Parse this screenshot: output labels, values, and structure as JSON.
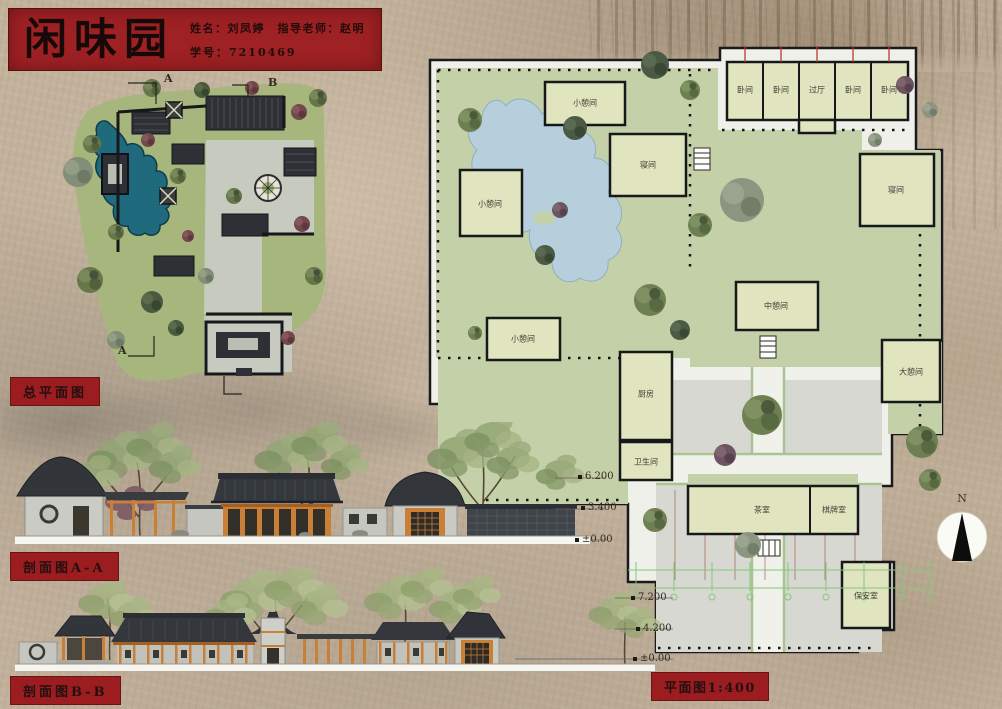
{
  "title_block": {
    "title": "闲味园",
    "name_line": "姓名：刘凤婷　指导老师：赵明",
    "id_line": "学号：7210469"
  },
  "labels": {
    "site_plan": "总平面图",
    "section_a": "剖面图A-A",
    "section_b": "剖面图B-B",
    "plan_scale": "平面图1:400"
  },
  "compass": {
    "north": "N"
  },
  "section_marks": {
    "top_a": "A",
    "top_b": "B",
    "bottom_a": "A"
  },
  "floor_plan": {
    "rooms": [
      {
        "label": "小憩间",
        "x": 163,
        "y": 81
      },
      {
        "label": "寝间",
        "x": 226,
        "y": 143
      },
      {
        "label": "卧间",
        "x": 323,
        "y": 68
      },
      {
        "label": "卧间",
        "x": 359,
        "y": 68
      },
      {
        "label": "过厅",
        "x": 395,
        "y": 68
      },
      {
        "label": "卧间",
        "x": 431,
        "y": 68
      },
      {
        "label": "卧间",
        "x": 467,
        "y": 68
      },
      {
        "label": "寝间",
        "x": 474,
        "y": 168
      },
      {
        "label": "小憩间",
        "x": 68,
        "y": 182
      },
      {
        "label": "中憩间",
        "x": 354,
        "y": 284
      },
      {
        "label": "小憩间",
        "x": 101,
        "y": 317
      },
      {
        "label": "大憩间",
        "x": 489,
        "y": 350
      },
      {
        "label": "厨房",
        "x": 224,
        "y": 372
      },
      {
        "label": "卫生间",
        "x": 224,
        "y": 440
      },
      {
        "label": "茶室",
        "x": 340,
        "y": 488
      },
      {
        "label": "棋牌室",
        "x": 412,
        "y": 488
      },
      {
        "label": "保安室",
        "x": 444,
        "y": 574
      }
    ]
  },
  "elevations": {
    "section_a_marks": [
      {
        "label": "6.200",
        "x": 563,
        "y": 49
      },
      {
        "label": "3.400",
        "x": 566,
        "y": 80
      },
      {
        "label": "±0.00",
        "x": 560,
        "y": 112
      }
    ],
    "section_b_marks": [
      {
        "label": "7.200",
        "x": 616,
        "y": 24
      },
      {
        "label": "4.200",
        "x": 621,
        "y": 55
      },
      {
        "label": "±0.00",
        "x": 618,
        "y": 85
      }
    ]
  },
  "colors": {
    "accent_red": "#9b1d20",
    "pond_teal": "#1f6a7c",
    "garden_green": "#a6b67d"
  }
}
